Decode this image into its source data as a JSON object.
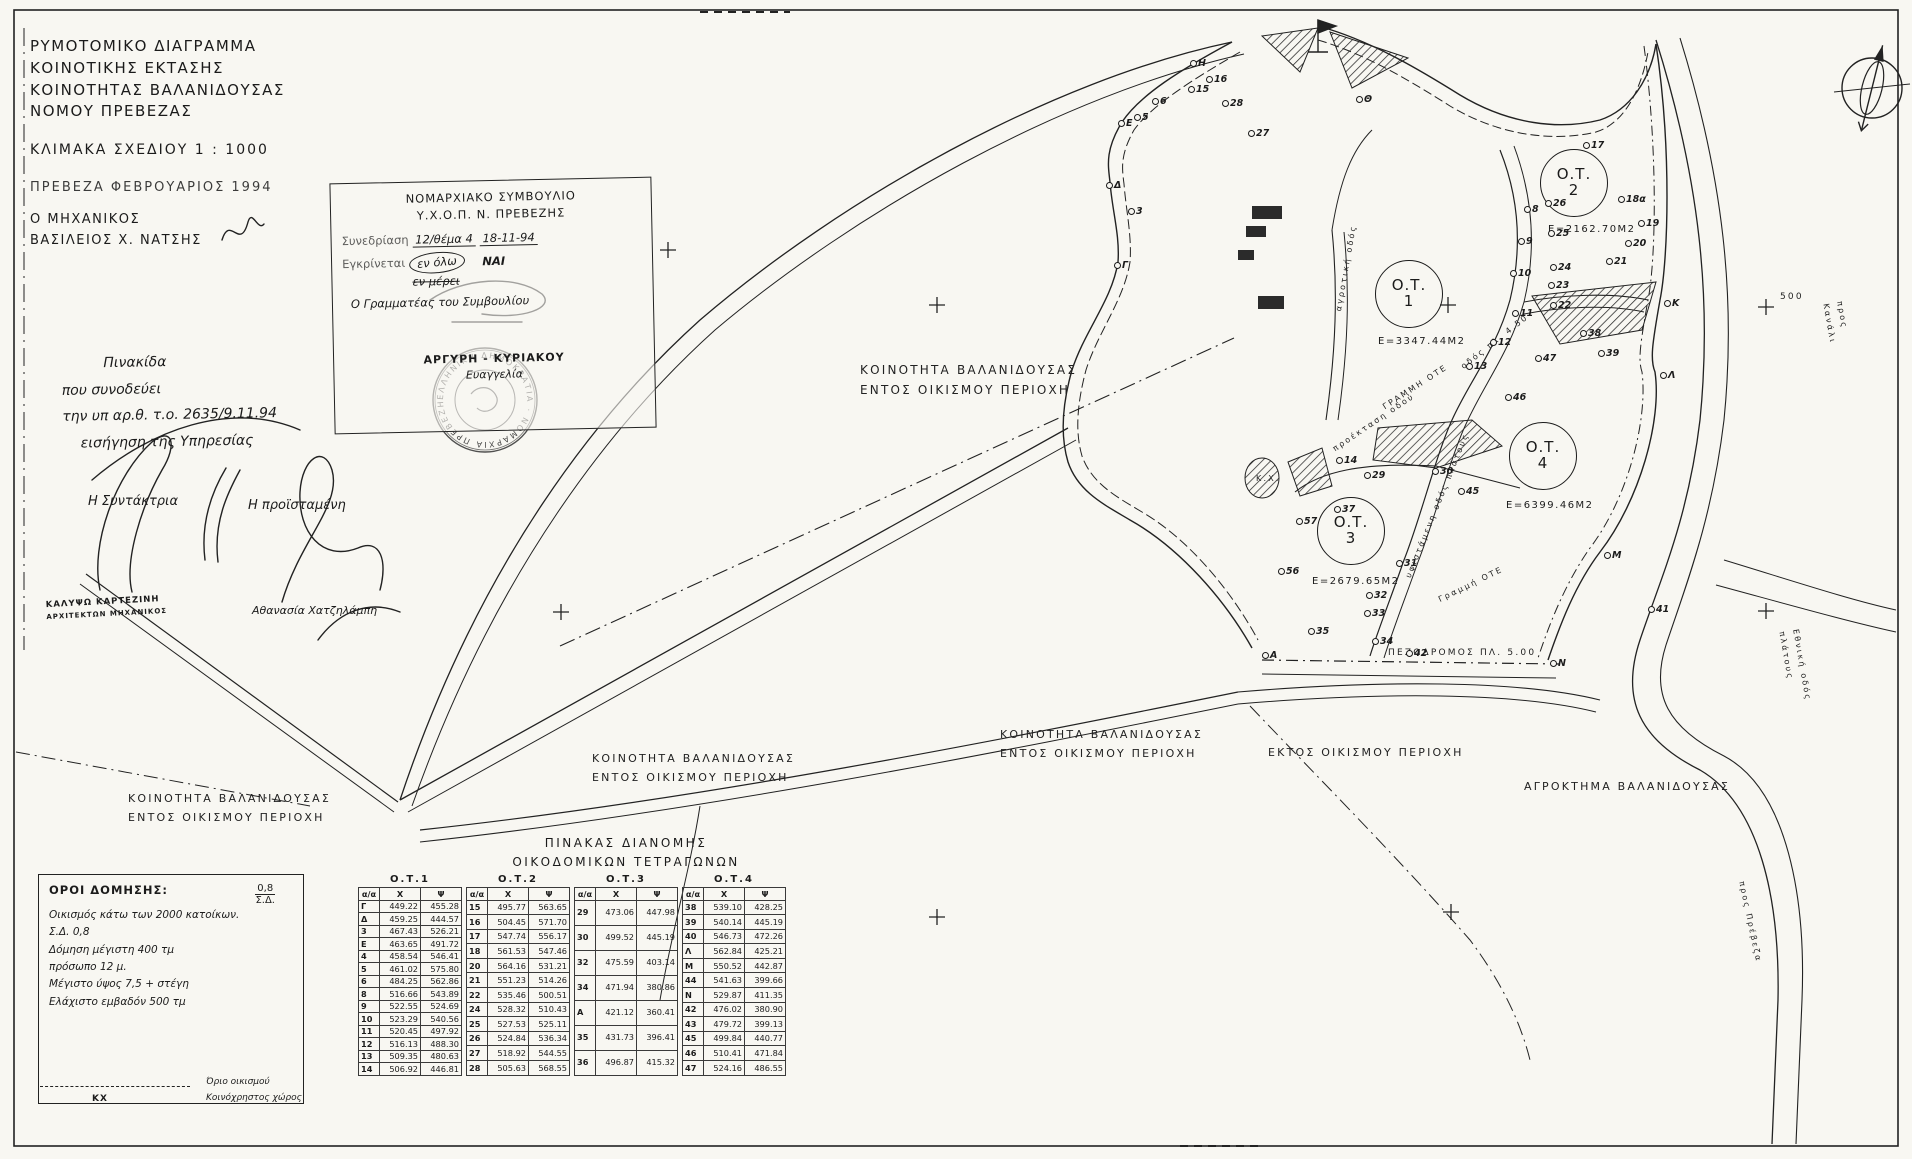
{
  "title": {
    "lines": [
      "ΡΥΜΟΤΟΜΙΚΟ ΔΙΑΓΡΑΜΜΑ",
      "ΚΟΙΝΟΤΙΚΗΣ ΕΚΤΑΣΗΣ",
      "ΚΟΙΝΟΤΗΤΑΣ ΒΑΛΑΝΙΔΟΥΣΑΣ",
      "ΝΟΜΟΥ ΠΡΕΒΕΖΑΣ"
    ],
    "scale": "ΚΛΙΜΑΚΑ ΣΧΕΔΙΟΥ 1 : 1000",
    "place_date": "ΠΡΕΒΕΖΑ ΦΕΒΡΟΥΑΡΙΟΣ 1994",
    "engineer_label": "Ο ΜΗΧΑΝΙΚΟΣ",
    "engineer_name": "ΒΑΣΙΛΕΙΟΣ Χ. ΝΑΤΣΗΣ"
  },
  "approval_stamp": {
    "line1": "ΝΟΜΑΡΧΙΑΚΟ ΣΥΜΒΟΥΛΙΟ",
    "line2": "Υ.Χ.Ο.Π.  Ν. ΠΡΕΒΕΖΗΣ",
    "session_label": "Συνεδρίαση",
    "session_value": "12/θέμα 4",
    "date_value": "18-11-94",
    "approve_label": "Εγκρίνεται",
    "en_olo": "εν όλω",
    "nai": "ΝΑΙ",
    "en_merei": "εν μέρει",
    "secretary": "Ο Γραμματέας του Συμβουλίου",
    "name": "ΑΡΓΥΡΗ - ΚΥΡΙΑΚΟΥ",
    "first_name": "Ευαγγελία"
  },
  "round_stamp_text": "ΕΛΛΗΝΙΚΗ ΔΗΜΟΚΡΑΤΙΑ · ΝΟΜΑΡΧΙΑ ΠΡΕΒΕΖΗΣ ·",
  "note": {
    "lines": [
      "Πινακίδα",
      "που συνοδεύει",
      "την υπ αρ.θ. τ.ο. 2635/9.11.94",
      "εισήγηση της Υπηρεσίας"
    ],
    "left_sig_label": "Η Συντάκτρια",
    "right_sig_label": "Η προϊσταμένη",
    "left_name": "ΚΑΛΥΨΩ ΚΑΡΤΕΖΙΝΗ",
    "left_title": "ΑΡΧΙΤΕΚΤΩΝ ΜΗΧΑΝΙΚΟΣ",
    "right_name": "Αθανασία Χατζηλάμπη"
  },
  "map": {
    "labels": [
      {
        "t": "ΚΟΙΝΟΤΗΤΑ ΒΑΛΑΝΙΔΟΥΣΑΣ\nΕΝΤΟΣ ΟΙΚΙΣΜΟΥ ΠΕΡΙΟΧΗ",
        "x": 860,
        "y": 360,
        "s": 12
      },
      {
        "t": "ΚΟΙΝΟΤΗΤΑ ΒΑΛΑΝΙΔΟΥΣΑΣ\nΕΝΤΟΣ ΟΙΚΙΣΜΟΥ ΠΕΡΙΟΧΗ",
        "x": 1000,
        "y": 726,
        "s": 11
      },
      {
        "t": "ΚΟΙΝΟΤΗΤΑ ΒΑΛΑΝΙΔΟΥΣΑΣ\nΕΝΤΟΣ ΟΙΚΙΣΜΟΥ ΠΕΡΙΟΧΗ",
        "x": 592,
        "y": 750,
        "s": 11
      },
      {
        "t": "ΚΟΙΝΟΤΗΤΑ ΒΑΛΑΝΙΔΟΥΣΑΣ\nΕΝΤΟΣ ΟΙΚΙΣΜΟΥ ΠΕΡΙΟΧΗ",
        "x": 128,
        "y": 790,
        "s": 11
      },
      {
        "t": "ΕΚΤΟΣ ΟΙΚΙΣΜΟΥ ΠΕΡΙΟΧΗ",
        "x": 1268,
        "y": 744,
        "s": 11
      },
      {
        "t": "ΑΓΡΟΚΤΗΜΑ ΒΑΛΑΝΙΔΟΥΣΑΣ",
        "x": 1524,
        "y": 778,
        "s": 11
      },
      {
        "t": "ΠΕΖΟΔΡΟΜΟΣ ΠΛ. 5.00",
        "x": 1388,
        "y": 646,
        "s": 9
      },
      {
        "t": "ΓΡΑΜΜΗ ΟΤΕ",
        "x": 1380,
        "y": 402,
        "s": 8,
        "r": -33
      },
      {
        "t": "οδός πλ. 4.50",
        "x": 1458,
        "y": 362,
        "s": 8,
        "r": -38
      },
      {
        "t": "υφιστάμενη οδός πλάτους",
        "x": 1402,
        "y": 575,
        "s": 8,
        "r": -68
      },
      {
        "t": "Γραμμή ΟΤΕ",
        "x": 1436,
        "y": 594,
        "s": 8,
        "r": -26
      },
      {
        "t": "προέκταση οδού",
        "x": 1330,
        "y": 444,
        "s": 8,
        "r": -34
      },
      {
        "t": "αγροτική οδός",
        "x": 1332,
        "y": 310,
        "s": 8,
        "r": -80
      },
      {
        "t": "Εθνική οδός πλάτους",
        "x": 1802,
        "y": 628,
        "s": 8,
        "r": 80
      },
      {
        "t": "προς Κανάλι",
        "x": 1846,
        "y": 300,
        "s": 8,
        "r": 80
      },
      {
        "t": "προς Πρέβεζα",
        "x": 1748,
        "y": 880,
        "s": 8,
        "r": 78
      },
      {
        "t": "500",
        "x": 1780,
        "y": 290,
        "s": 9
      },
      {
        "t": "Κ.Χ.",
        "x": 1256,
        "y": 472,
        "s": 8
      }
    ],
    "blocks": [
      {
        "num": "1",
        "label": "Ο.Τ.",
        "area": "Ε=3347.44Μ2",
        "cx": 1408,
        "cy": 293,
        "ax": 1378,
        "ay": 336
      },
      {
        "num": "2",
        "label": "Ο.Τ.",
        "area": "Ε=2162.70Μ2",
        "cx": 1573,
        "cy": 182,
        "ax": 1548,
        "ay": 224
      },
      {
        "num": "3",
        "label": "Ο.Τ.",
        "area": "Ε=2679.65Μ2",
        "cx": 1350,
        "cy": 530,
        "ax": 1312,
        "ay": 576
      },
      {
        "num": "4",
        "label": "Ο.Τ.",
        "area": "Ε=6399.46Μ2",
        "cx": 1542,
        "cy": 455,
        "ax": 1506,
        "ay": 500
      }
    ],
    "points": [
      {
        "n": "Ε",
        "x": 1118,
        "y": 118
      },
      {
        "n": "Δ",
        "x": 1106,
        "y": 180
      },
      {
        "n": "Γ",
        "x": 1114,
        "y": 260
      },
      {
        "n": "Η",
        "x": 1190,
        "y": 58
      },
      {
        "n": "Θ",
        "x": 1356,
        "y": 94
      },
      {
        "n": "Κ",
        "x": 1664,
        "y": 298
      },
      {
        "n": "Λ",
        "x": 1660,
        "y": 370
      },
      {
        "n": "Μ",
        "x": 1604,
        "y": 550
      },
      {
        "n": "Ν",
        "x": 1550,
        "y": 658
      },
      {
        "n": "Α",
        "x": 1262,
        "y": 650
      },
      {
        "n": "3",
        "x": 1128,
        "y": 206
      },
      {
        "n": "5",
        "x": 1134,
        "y": 112
      },
      {
        "n": "6",
        "x": 1152,
        "y": 96
      },
      {
        "n": "15",
        "x": 1188,
        "y": 84
      },
      {
        "n": "16",
        "x": 1206,
        "y": 74
      },
      {
        "n": "28",
        "x": 1222,
        "y": 98
      },
      {
        "n": "27",
        "x": 1248,
        "y": 128
      },
      {
        "n": "8",
        "x": 1524,
        "y": 204
      },
      {
        "n": "9",
        "x": 1518,
        "y": 236
      },
      {
        "n": "26",
        "x": 1545,
        "y": 198
      },
      {
        "n": "25",
        "x": 1548,
        "y": 228
      },
      {
        "n": "24",
        "x": 1550,
        "y": 262
      },
      {
        "n": "23",
        "x": 1548,
        "y": 280
      },
      {
        "n": "22",
        "x": 1550,
        "y": 300
      },
      {
        "n": "10",
        "x": 1510,
        "y": 268
      },
      {
        "n": "11",
        "x": 1512,
        "y": 308
      },
      {
        "n": "12",
        "x": 1490,
        "y": 337
      },
      {
        "n": "13",
        "x": 1466,
        "y": 361
      },
      {
        "n": "47",
        "x": 1535,
        "y": 353
      },
      {
        "n": "46",
        "x": 1505,
        "y": 392
      },
      {
        "n": "17",
        "x": 1583,
        "y": 140
      },
      {
        "n": "18α",
        "x": 1618,
        "y": 194
      },
      {
        "n": "19",
        "x": 1638,
        "y": 218
      },
      {
        "n": "20",
        "x": 1625,
        "y": 238
      },
      {
        "n": "21",
        "x": 1606,
        "y": 256
      },
      {
        "n": "38",
        "x": 1580,
        "y": 328
      },
      {
        "n": "39",
        "x": 1598,
        "y": 348
      },
      {
        "n": "14",
        "x": 1336,
        "y": 455
      },
      {
        "n": "29",
        "x": 1364,
        "y": 470
      },
      {
        "n": "30",
        "x": 1432,
        "y": 466
      },
      {
        "n": "45",
        "x": 1458,
        "y": 486
      },
      {
        "n": "31",
        "x": 1396,
        "y": 558
      },
      {
        "n": "37",
        "x": 1334,
        "y": 504
      },
      {
        "n": "57",
        "x": 1296,
        "y": 516
      },
      {
        "n": "56",
        "x": 1278,
        "y": 566
      },
      {
        "n": "32",
        "x": 1366,
        "y": 590
      },
      {
        "n": "33",
        "x": 1364,
        "y": 608
      },
      {
        "n": "34",
        "x": 1372,
        "y": 636
      },
      {
        "n": "35",
        "x": 1308,
        "y": 626
      },
      {
        "n": "42",
        "x": 1406,
        "y": 648
      },
      {
        "n": "41",
        "x": 1648,
        "y": 604
      }
    ]
  },
  "tables": {
    "title_line1": "ΠΙΝΑΚΑΣ ΔΙΑΝΟΜΗΣ",
    "title_line2": "ΟΙΚΟΔΟΜΙΚΩΝ ΤΕΤΡΑΓΩΝΩΝ",
    "col_headers": [
      "α/α",
      "Χ",
      "Ψ"
    ],
    "groups": [
      {
        "name": "Ο.Τ.1",
        "rows": [
          [
            "Γ",
            "449.22",
            "455.28"
          ],
          [
            "Δ",
            "459.25",
            "444.57"
          ],
          [
            "3",
            "467.43",
            "526.21"
          ],
          [
            "Ε",
            "463.65",
            "491.72"
          ],
          [
            "4",
            "458.54",
            "546.41"
          ],
          [
            "5",
            "461.02",
            "575.80"
          ],
          [
            "6",
            "484.25",
            "562.86"
          ],
          [
            "8",
            "516.66",
            "543.89"
          ],
          [
            "9",
            "522.55",
            "524.69"
          ],
          [
            "10",
            "523.29",
            "540.56"
          ],
          [
            "11",
            "520.45",
            "497.92"
          ],
          [
            "12",
            "516.13",
            "488.30"
          ],
          [
            "13",
            "509.35",
            "480.63"
          ],
          [
            "14",
            "506.92",
            "446.81"
          ]
        ]
      },
      {
        "name": "Ο.Τ.2",
        "rows": [
          [
            "15",
            "495.77",
            "563.65"
          ],
          [
            "16",
            "504.45",
            "571.70"
          ],
          [
            "17",
            "547.74",
            "556.17"
          ],
          [
            "18",
            "561.53",
            "547.46"
          ],
          [
            "20",
            "564.16",
            "531.21"
          ],
          [
            "21",
            "551.23",
            "514.26"
          ],
          [
            "22",
            "535.46",
            "500.51"
          ],
          [
            "24",
            "528.32",
            "510.43"
          ],
          [
            "25",
            "527.53",
            "525.11"
          ],
          [
            "26",
            "524.84",
            "536.34"
          ],
          [
            "27",
            "518.92",
            "544.55"
          ],
          [
            "28",
            "505.63",
            "568.55"
          ]
        ]
      },
      {
        "name": "Ο.Τ.3",
        "rows": [
          [
            "29",
            "473.06",
            "447.98"
          ],
          [
            "30",
            "499.52",
            "445.19"
          ],
          [
            "32",
            "475.59",
            "403.14"
          ],
          [
            "34",
            "471.94",
            "380.86"
          ],
          [
            "Α",
            "421.12",
            "360.41"
          ],
          [
            "35",
            "431.73",
            "396.41"
          ],
          [
            "36",
            "496.87",
            "415.32"
          ]
        ]
      },
      {
        "name": "Ο.Τ.4",
        "rows": [
          [
            "38",
            "539.10",
            "428.25"
          ],
          [
            "39",
            "540.14",
            "445.19"
          ],
          [
            "40",
            "546.73",
            "472.26"
          ],
          [
            "Λ",
            "562.84",
            "425.21"
          ],
          [
            "Μ",
            "550.52",
            "442.87"
          ],
          [
            "44",
            "541.63",
            "399.66"
          ],
          [
            "Ν",
            "529.87",
            "411.35"
          ],
          [
            "42",
            "476.02",
            "380.90"
          ],
          [
            "43",
            "479.72",
            "399.13"
          ],
          [
            "45",
            "499.84",
            "440.77"
          ],
          [
            "46",
            "510.41",
            "471.84"
          ],
          [
            "47",
            "524.16",
            "486.55"
          ]
        ]
      }
    ]
  },
  "terms": {
    "title": "ΟΡΟΙ ΔΟΜΗΣΗΣ:",
    "frac_top": "0,8",
    "frac_bottom": "Σ.Δ.",
    "lines": [
      "Οικισμός κάτω των 2000 κατοίκων.",
      "Σ.Δ. 0,8",
      "Δόμηση μέγιστη 400 τμ",
      "πρόσωπο 12 μ.",
      "Μέγιστο ύψος 7,5 + στέγη",
      "Ελάχιστο εμβαδόν 500 τμ"
    ]
  },
  "legend": {
    "kx": "ΚΧ",
    "line1": "Όριο οικισμού",
    "line2": "Κοινόχρηστος χώρος"
  }
}
